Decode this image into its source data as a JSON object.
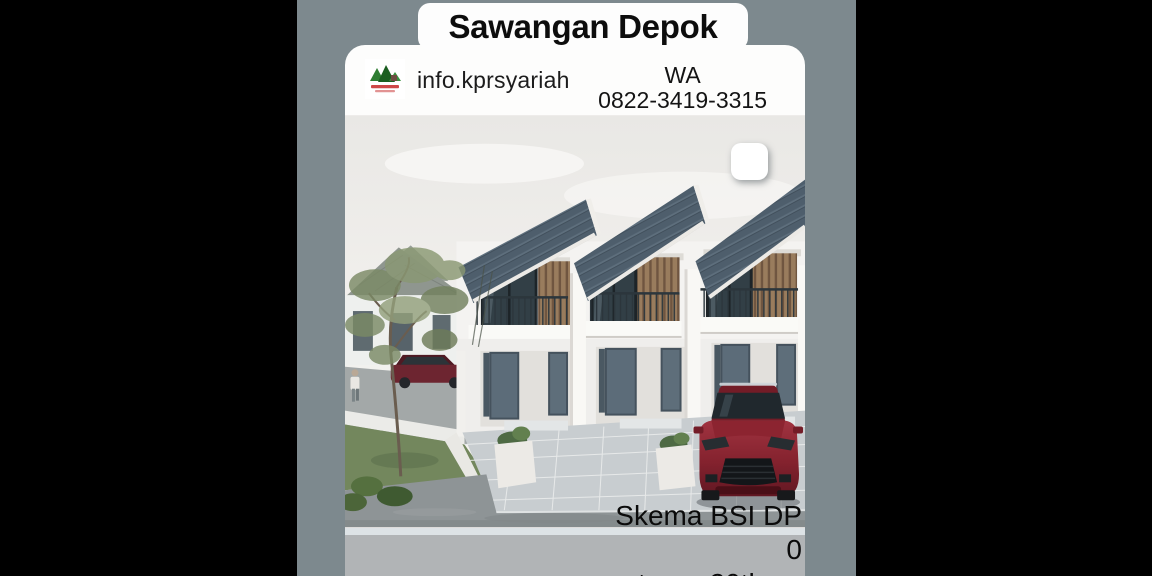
{
  "colors": {
    "letterbox": "#000000",
    "story_background": "#7d898e",
    "card": "#fdfdfc",
    "bottom_band": "#b1b4b6",
    "text": "#0d0d0d"
  },
  "title_card": {
    "text": "Sawangan Depok"
  },
  "header": {
    "logo_icon": "green-hills-house-logo",
    "handle": "info.kprsyariah",
    "wa_label": "WA",
    "wa_number": "0822-3419-3315"
  },
  "photo": {
    "alt": "3D exterior render of three two-storey terraced houses with dark slate pitched roofs, wood-slat balcony accents, dark grey doors, tiled driveways, a dark red car parked in front, a tree, lawn and neighbouring houses in the background"
  },
  "caption": {
    "line1": "Skema BSI DP 0",
    "line2": "tenor 20th"
  },
  "sticker": {
    "icon": "rounded-square-sticker"
  }
}
